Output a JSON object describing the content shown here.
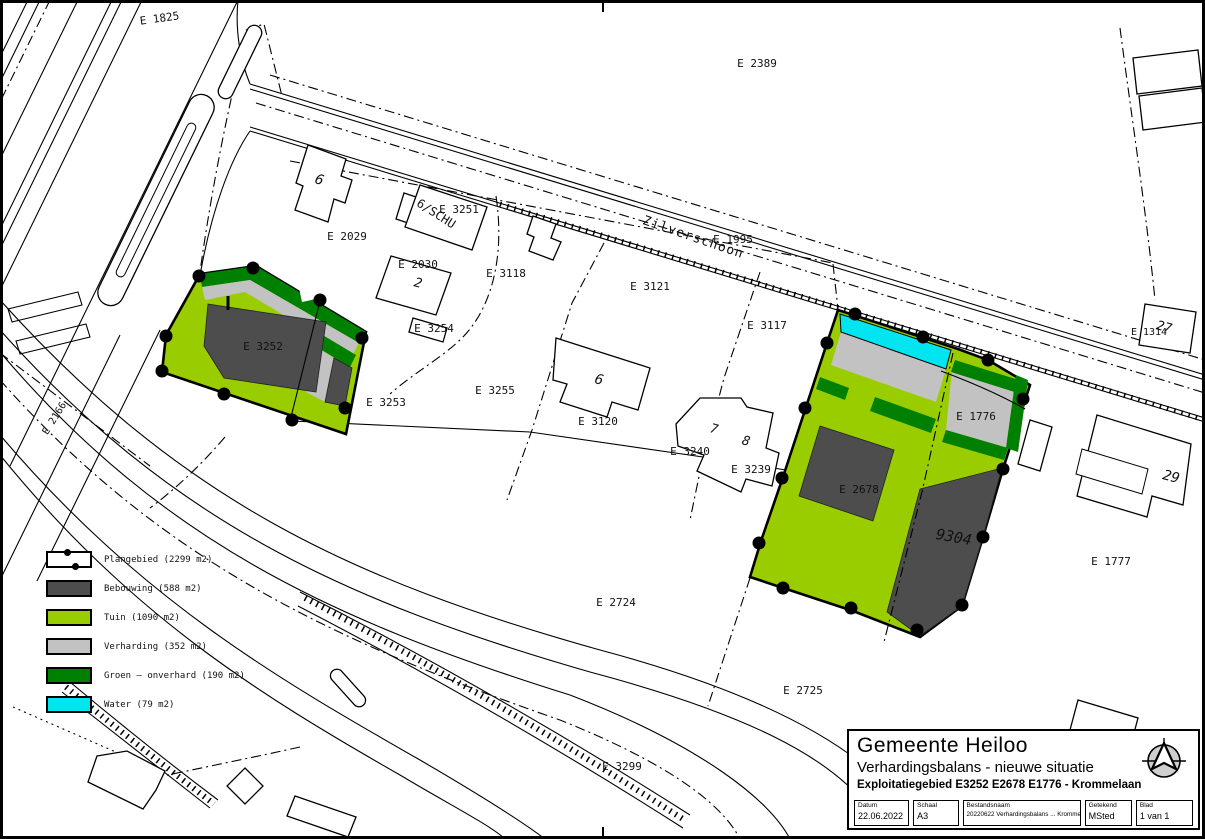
{
  "colors": {
    "plangebied": "#ffffff",
    "bebouwing": "#4d4d4d",
    "tuin": "#9acd00",
    "verharding": "#c2c2c2",
    "groen": "#008000",
    "water": "#00e5f0"
  },
  "legend": {
    "items": [
      {
        "key": "plangebied",
        "label": "Plangebied (2299 m2)",
        "color": "#ffffff"
      },
      {
        "key": "bebouwing",
        "label": "Bebouwing (588 m2)",
        "color": "#4d4d4d"
      },
      {
        "key": "tuin",
        "label": "Tuin (1090 m2)",
        "color": "#9acd00"
      },
      {
        "key": "verharding",
        "label": "Verharding (352 m2)",
        "color": "#c2c2c2"
      },
      {
        "key": "groen",
        "label": "Groen – onverhard (190 m2)",
        "color": "#008000"
      },
      {
        "key": "water",
        "label": "Water (79 m2)",
        "color": "#00e5f0"
      }
    ]
  },
  "map": {
    "labels": [
      {
        "text": "E 1825",
        "x": 160,
        "y": 22,
        "rot": -8
      },
      {
        "text": "E 2389",
        "x": 757,
        "y": 67
      },
      {
        "text": "6",
        "x": 318,
        "y": 184,
        "size": 14,
        "italic": true,
        "rot": 18
      },
      {
        "text": "E 2029",
        "x": 347,
        "y": 240
      },
      {
        "text": "6/SCHU",
        "x": 434,
        "y": 217,
        "rot": 33,
        "size": 12
      },
      {
        "text": "E 3251",
        "x": 459,
        "y": 213
      },
      {
        "text": "E 2030",
        "x": 418,
        "y": 268
      },
      {
        "text": "2",
        "x": 417,
        "y": 287,
        "size": 13,
        "italic": true,
        "rot": 15
      },
      {
        "text": "E 3254",
        "x": 434,
        "y": 332
      },
      {
        "text": "E 3118",
        "x": 506,
        "y": 277
      },
      {
        "text": "E 3121",
        "x": 650,
        "y": 290
      },
      {
        "text": "Zilverschoon",
        "x": 692,
        "y": 241,
        "rot": 19,
        "size": 13,
        "spacing": 1,
        "name": "street-label-zilverschoon"
      },
      {
        "text": "E 1995",
        "x": 733,
        "y": 243
      },
      {
        "text": "E 3117",
        "x": 767,
        "y": 329
      },
      {
        "text": "E 3252",
        "x": 263,
        "y": 350
      },
      {
        "text": "E 3253",
        "x": 386,
        "y": 406
      },
      {
        "text": "E 3255",
        "x": 495,
        "y": 394
      },
      {
        "text": "6",
        "x": 598,
        "y": 384,
        "size": 14,
        "italic": true,
        "rot": 15
      },
      {
        "text": "E 3120",
        "x": 598,
        "y": 425
      },
      {
        "text": "7",
        "x": 713,
        "y": 433,
        "size": 13,
        "italic": true,
        "rot": 15
      },
      {
        "text": "8",
        "x": 745,
        "y": 445,
        "size": 13,
        "italic": true,
        "rot": 15
      },
      {
        "text": "E 3240",
        "x": 690,
        "y": 455
      },
      {
        "text": "E 3239",
        "x": 751,
        "y": 473
      },
      {
        "text": "E 1776",
        "x": 976,
        "y": 420
      },
      {
        "text": "E 2678",
        "x": 859,
        "y": 493
      },
      {
        "text": "9304",
        "x": 953,
        "y": 542,
        "size": 15,
        "italic": true,
        "rot": 10
      },
      {
        "text": "E 2724",
        "x": 616,
        "y": 606
      },
      {
        "text": "E 2725",
        "x": 803,
        "y": 694
      },
      {
        "text": "E 3299",
        "x": 622,
        "y": 770
      },
      {
        "text": "E 2166",
        "x": 57,
        "y": 420,
        "rot": -58,
        "size": 10
      },
      {
        "text": "27",
        "x": 1163,
        "y": 331,
        "size": 13,
        "italic": true,
        "rot": 15
      },
      {
        "text": "E 1314",
        "x": 1149,
        "y": 335,
        "size": 10
      },
      {
        "text": "29",
        "x": 1170,
        "y": 481,
        "size": 14,
        "italic": true,
        "rot": 15
      },
      {
        "text": "E 1777",
        "x": 1111,
        "y": 565
      }
    ]
  },
  "title_block": {
    "municipality": "Gemeente Heiloo",
    "project": "Verhardingsbalans - nieuwe situatie",
    "area": "Exploitatiegebied E3252 E2678 E1776 - Krommelaan",
    "fields": [
      {
        "label": "Datum",
        "value": "22.06.2022"
      },
      {
        "label": "Schaal",
        "value": "A3"
      },
      {
        "label": "Bestandsnaam",
        "value": "20220622 Verhardingsbalans ... Krommelaan"
      },
      {
        "label": "Getekend",
        "value": "MSted"
      },
      {
        "label": "Blad",
        "value": "1 van 1"
      }
    ]
  }
}
